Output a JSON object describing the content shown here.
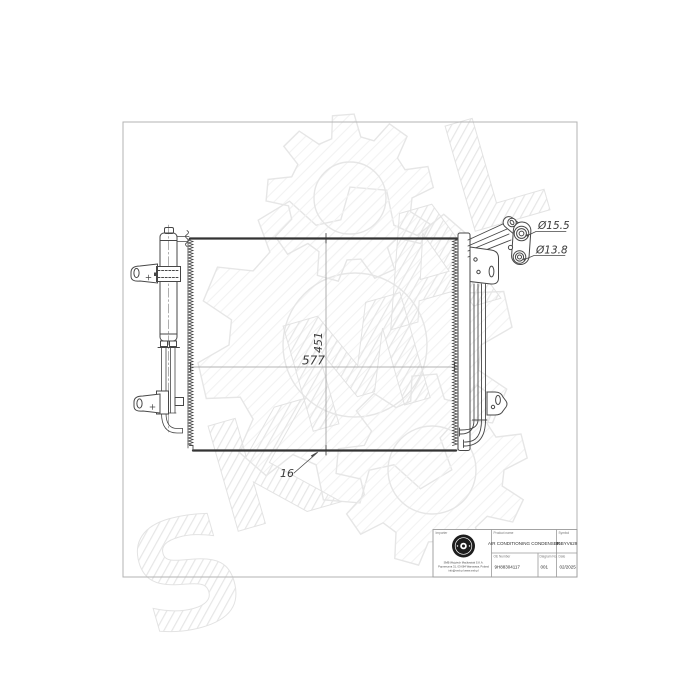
{
  "watermark": {
    "letters": [
      "S",
      "K",
      "M",
      "A",
      "L"
    ]
  },
  "dimensions": {
    "port_top_diameter": "Ø15.5",
    "port_bottom_diameter": "Ø13.8",
    "core_width": "577",
    "core_height": "451",
    "core_thickness": "16"
  },
  "title_block": {
    "importer": {
      "label": "Importer",
      "company_name": "SMB Wojciech Maćkowiak S.K.A.",
      "address": "Poprzeczna 31, 03-084 Warszawa, Poland",
      "contact": "info@smb.pl  www.smb.pl"
    },
    "product": {
      "label": "Product name",
      "value": "AIR CONDITIONING CONDENSER"
    },
    "symbol": {
      "label": "Symbol",
      "value": "86BYV629"
    },
    "oe": {
      "label": "OE Number",
      "value": "9H88304117"
    },
    "diagram": {
      "label": "Diagram No.",
      "value": "001"
    },
    "date": {
      "label": "Date",
      "value": "02/2025"
    }
  }
}
